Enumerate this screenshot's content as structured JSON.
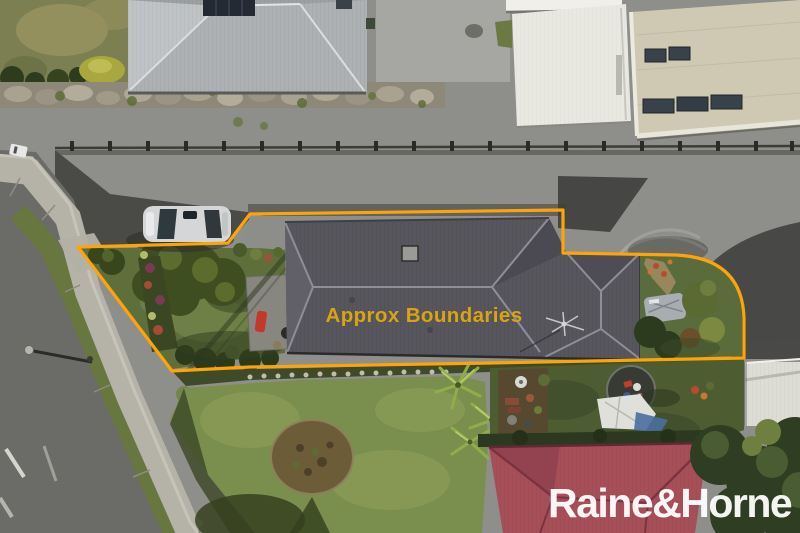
{
  "overlay": {
    "boundary_label": "Approx Boundaries",
    "watermark_text": "Raine&Horne",
    "boundary_line_color": "#FFA408",
    "boundary_label_color": "#D8A410",
    "watermark_color": "#FFFFFF"
  },
  "palette": {
    "concrete": "#8E8E8A",
    "concrete_shadow": "#4A4A47",
    "asphalt_road": "#6B6B67",
    "footpath": "#B5B3A8",
    "subject_roof": "#57565D",
    "neighbor_roof_gray": "#AEB1B3",
    "neighbor_roof_red": "#A64F59",
    "warehouse_beige": "#CFC9B4",
    "shed_white": "#E9E8E1",
    "front_lawn": "#5E6F3C",
    "back_lawn": "#7A8F4D",
    "dark_lawn": "#4E5C31",
    "grass_verge": "#7B7F52",
    "car_silver": "#D4D6D7"
  }
}
